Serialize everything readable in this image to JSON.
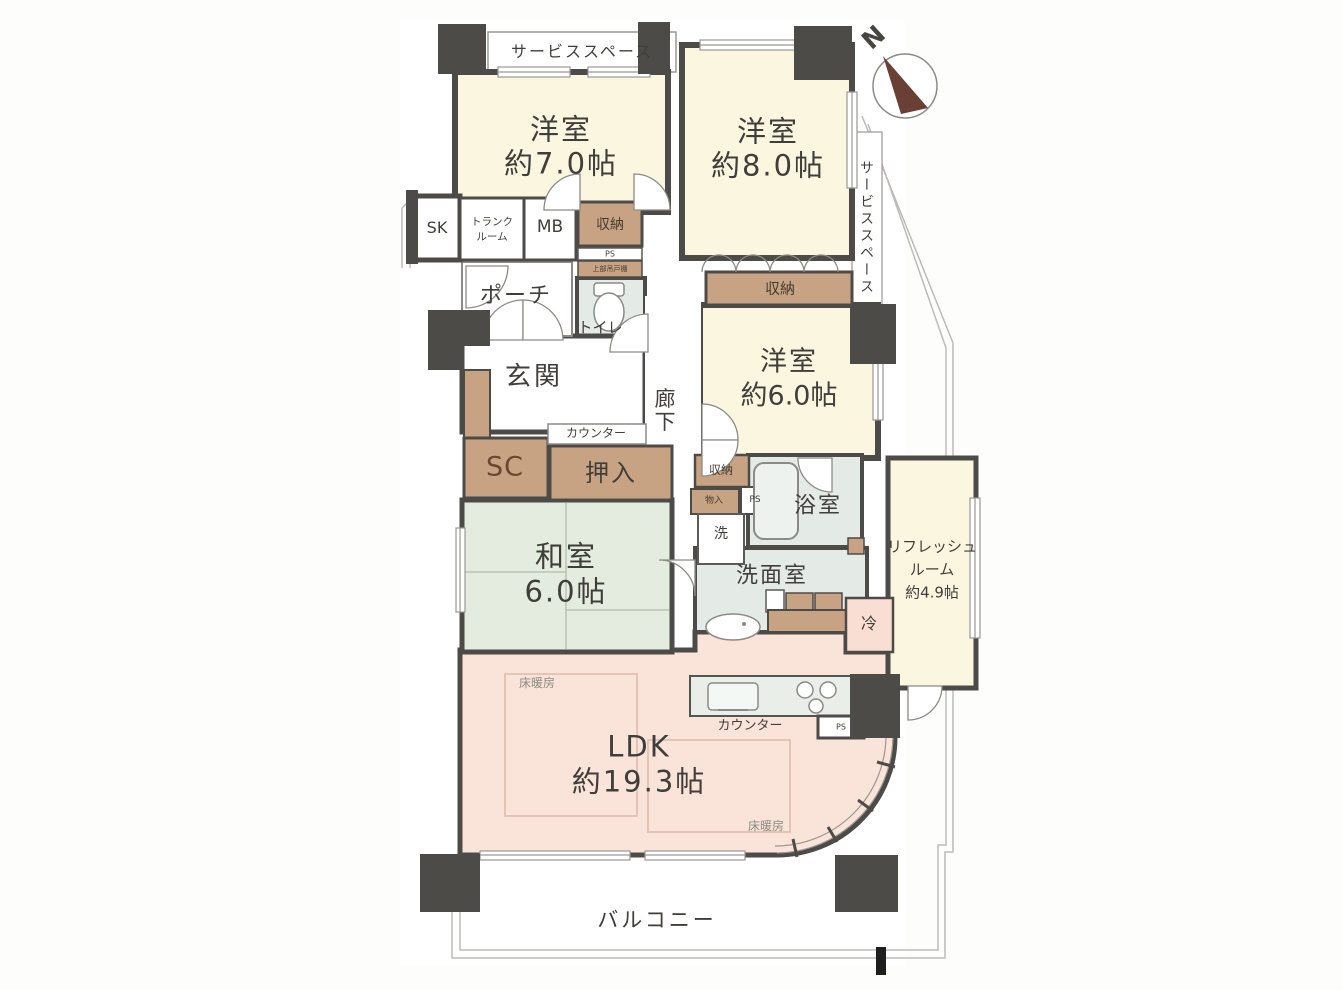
{
  "labels": {
    "compass_n": "N",
    "service_top": "サービススペース",
    "service_right": "サービススペース",
    "w1_name": "洋室",
    "w1_size": "約7.0帖",
    "w2_name": "洋室",
    "w2_size": "約8.0帖",
    "w3_name": "洋室",
    "w3_size": "約6.0帖",
    "sk": "SK",
    "trunk_line1": "トランク",
    "trunk_line2": "ルーム",
    "mb": "MB",
    "closet_mb": "収納",
    "ps_top": "PS",
    "hanging_cabinet": "上部吊戸棚",
    "toilet": "トイレ",
    "porch": "ポーチ",
    "genkan": "玄関",
    "roka_line1": "廊",
    "roka_line2": "下",
    "counter_genkan": "カウンター",
    "sc": "SC",
    "oshiire": "押入",
    "washitsu_name": "和室",
    "washitsu_size": "6.0帖",
    "closet_w2": "収納",
    "closet_w3": "収納",
    "monoire": "物入",
    "ps_mid": "PS",
    "washer": "洗",
    "bath": "浴室",
    "washroom": "洗面室",
    "refresh_line1": "リフレッシュ",
    "refresh_line2": "ルーム",
    "refresh_line3": "約4.9帖",
    "fridge": "冷",
    "ldk_name": "LDK",
    "ldk_size": "約19.3帖",
    "floor_heat1": "床暖房",
    "floor_heat2": "床暖房",
    "counter_kitchen": "カウンター",
    "ps_kitchen": "PS",
    "balcony": "バルコニー"
  },
  "colors": {
    "wall": "#4d4b47",
    "room_cream": "#fbf6df",
    "room_pink": "#fae3d9",
    "tatami_green": "#e4ecdf",
    "wet_green": "#e4ebe7",
    "storage_brown": "#c8a383",
    "compass_needle": "#6a4036",
    "floor_heat_outline": "#dcb9aa",
    "property_line": "#bdbbb7"
  }
}
